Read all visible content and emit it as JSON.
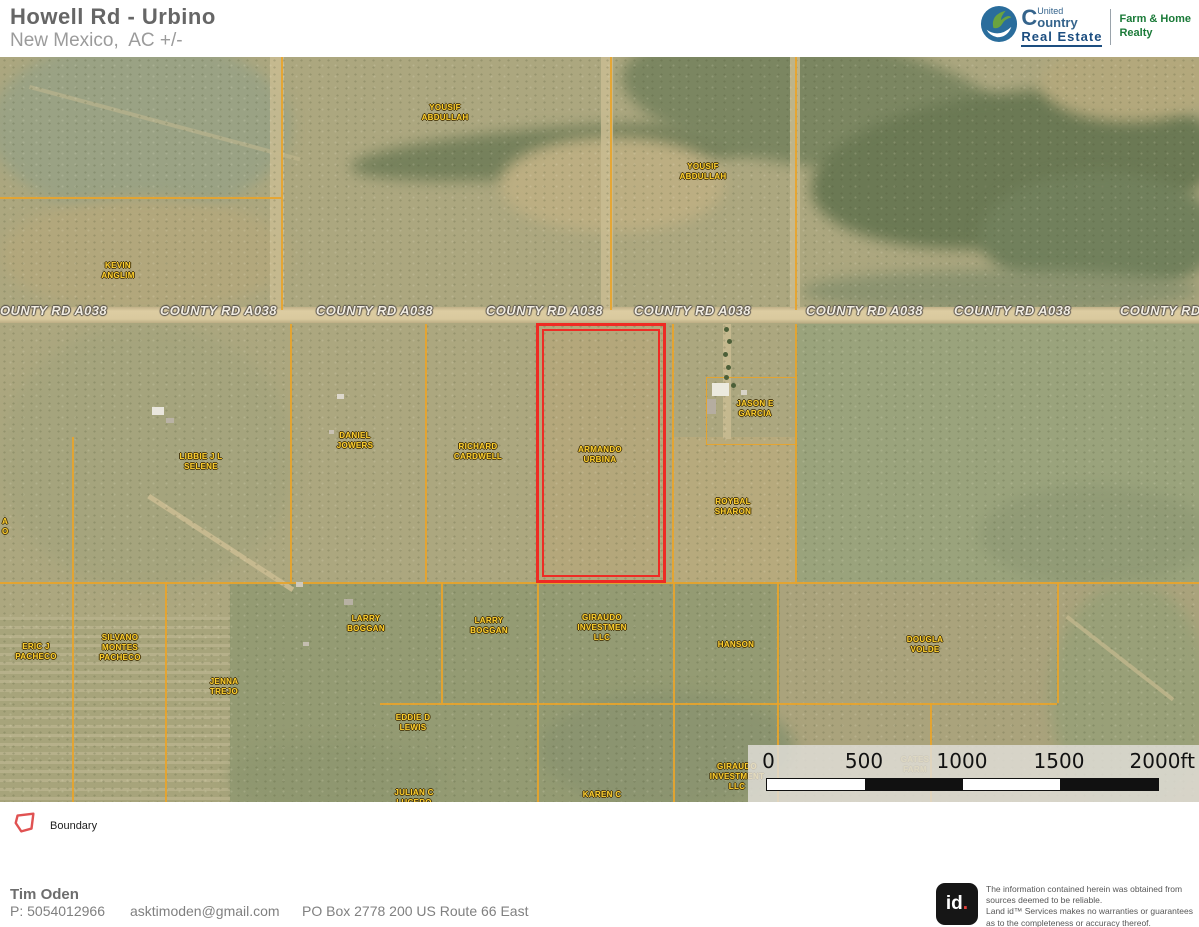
{
  "header": {
    "title": "Howell Rd - Urbino",
    "subtitle": "New Mexico,  AC +/-"
  },
  "brand": {
    "initial": "C",
    "name_small": "United",
    "name_rest": "ountry",
    "tagline": "Real Estate",
    "division_line1": "Farm & Home",
    "division_line2": "Realty"
  },
  "map": {
    "road": {
      "label": "COUNTY RD A038",
      "instances": [
        {
          "x": 0,
          "text": "OUNTY RD A038"
        },
        {
          "x": 160
        },
        {
          "x": 316
        },
        {
          "x": 486
        },
        {
          "x": 634
        },
        {
          "x": 806
        },
        {
          "x": 954
        },
        {
          "x": 1120,
          "text": "COUNTY RD"
        }
      ]
    },
    "parcel_labels": [
      {
        "lines": [
          "YOUSIF",
          "ABDULLAH"
        ],
        "x": 445,
        "y": 56
      },
      {
        "lines": [
          "YOUSIF",
          "ABDULLAH"
        ],
        "x": 703,
        "y": 115
      },
      {
        "lines": [
          "KEVIN",
          "ANGLIM"
        ],
        "x": 118,
        "y": 214
      },
      {
        "lines": [
          "LIBBIE J L",
          "SELENE"
        ],
        "x": 201,
        "y": 405
      },
      {
        "lines": [
          "DANIEL",
          "JOWERS"
        ],
        "x": 355,
        "y": 384
      },
      {
        "lines": [
          "RICHARD",
          "CARDWELL"
        ],
        "x": 478,
        "y": 395
      },
      {
        "lines": [
          "ARMANDO",
          "URBINA"
        ],
        "x": 600,
        "y": 398
      },
      {
        "lines": [
          "JASON E",
          "GARCIA"
        ],
        "x": 755,
        "y": 352
      },
      {
        "lines": [
          "ROYBAL",
          "SHARON"
        ],
        "x": 733,
        "y": 450
      },
      {
        "lines": [
          "ERIC J",
          "PACHECO"
        ],
        "x": 36,
        "y": 595
      },
      {
        "lines": [
          "SILVANO",
          "MONTES",
          "PACHECO"
        ],
        "x": 120,
        "y": 591
      },
      {
        "lines": [
          "JENNA",
          "TREJO"
        ],
        "x": 224,
        "y": 630
      },
      {
        "lines": [
          "LARRY",
          "BOGGAN"
        ],
        "x": 366,
        "y": 567
      },
      {
        "lines": [
          "LARRY",
          "BOGGAN"
        ],
        "x": 489,
        "y": 569
      },
      {
        "lines": [
          "GIRAUDO",
          "INVESTMEN",
          "LLC"
        ],
        "x": 602,
        "y": 571
      },
      {
        "lines": [
          "HANSON"
        ],
        "x": 736,
        "y": 588
      },
      {
        "lines": [
          "DOUGLA",
          "VOLDE"
        ],
        "x": 925,
        "y": 588
      },
      {
        "lines": [
          "EDDIE D",
          "LEWIS"
        ],
        "x": 413,
        "y": 666
      },
      {
        "lines": [
          "JULIAN C",
          "LUCERO"
        ],
        "x": 414,
        "y": 741
      },
      {
        "lines": [
          "KAREN C"
        ],
        "x": 602,
        "y": 738
      },
      {
        "lines": [
          "GIRAUDO",
          "INVESTMENT",
          "LLC"
        ],
        "x": 737,
        "y": 720
      },
      {
        "lines": [
          "GATES",
          "FARM"
        ],
        "x": 915,
        "y": 708,
        "faint": true
      },
      {
        "lines": [
          "A",
          "O"
        ],
        "x": 2,
        "y": 470,
        "edge": true
      }
    ],
    "scale_bar": {
      "tick_labels": [
        "0",
        "500",
        "1000",
        "1500",
        "2000ft"
      ],
      "tick_x": [
        766,
        864,
        962,
        1059,
        1157
      ]
    },
    "colors": {
      "boundary_red": "#ee2b24",
      "parcel_line_orange": "#e9a42a",
      "owner_label_yellow": "#ffd02e",
      "road_text": "#f2ede2"
    }
  },
  "legend": {
    "items": [
      {
        "label": "Boundary",
        "icon": "boundary-polygon-icon"
      }
    ]
  },
  "footer": {
    "agent_name": "Tim Oden",
    "phone": "P: 5054012966",
    "email": "asktimoden@gmail.com",
    "address": "PO Box 2778 200 US Route 66 East"
  },
  "land_id": {
    "logo_text": "id.",
    "disclaimer_lines": [
      "The information contained herein was obtained from",
      "sources deemed to be reliable.",
      "Land id™ Services makes no warranties or guarantees",
      "as to the completeness or accuracy thereof."
    ]
  }
}
